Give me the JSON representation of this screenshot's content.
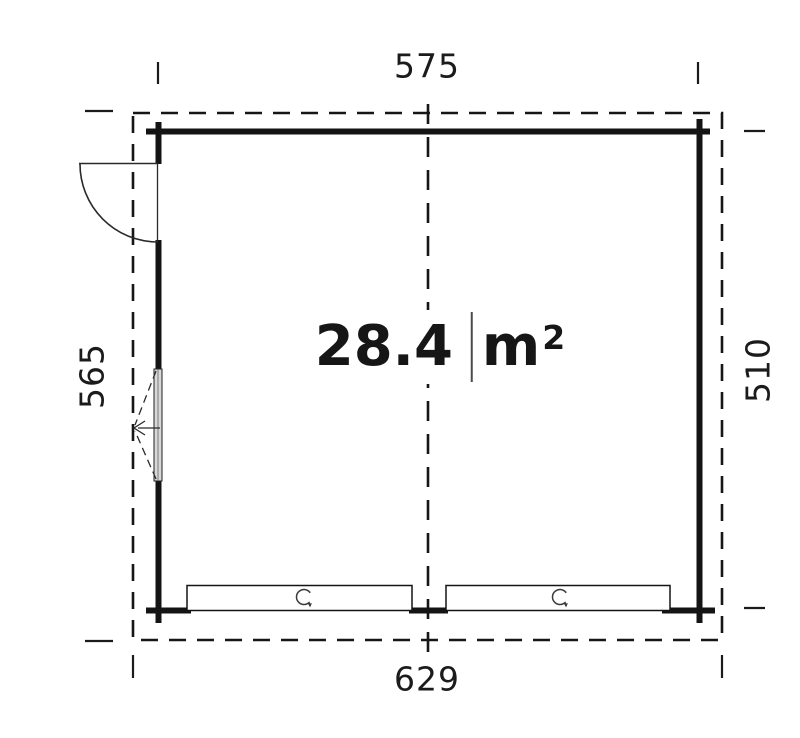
{
  "plan": {
    "area": {
      "value": "28.4",
      "unit": "m",
      "exponent": "2"
    },
    "dimensions": {
      "top": "575",
      "bottom": "629",
      "left": "565",
      "right": "510"
    },
    "icons": {
      "door": "door-swing-icon",
      "window": "window-tilt-icon",
      "garage_doors": "rotation-arrow-icon"
    },
    "colors": {
      "line": "#141414",
      "window_fill": "#d8d8d8",
      "background": "#ffffff"
    }
  }
}
